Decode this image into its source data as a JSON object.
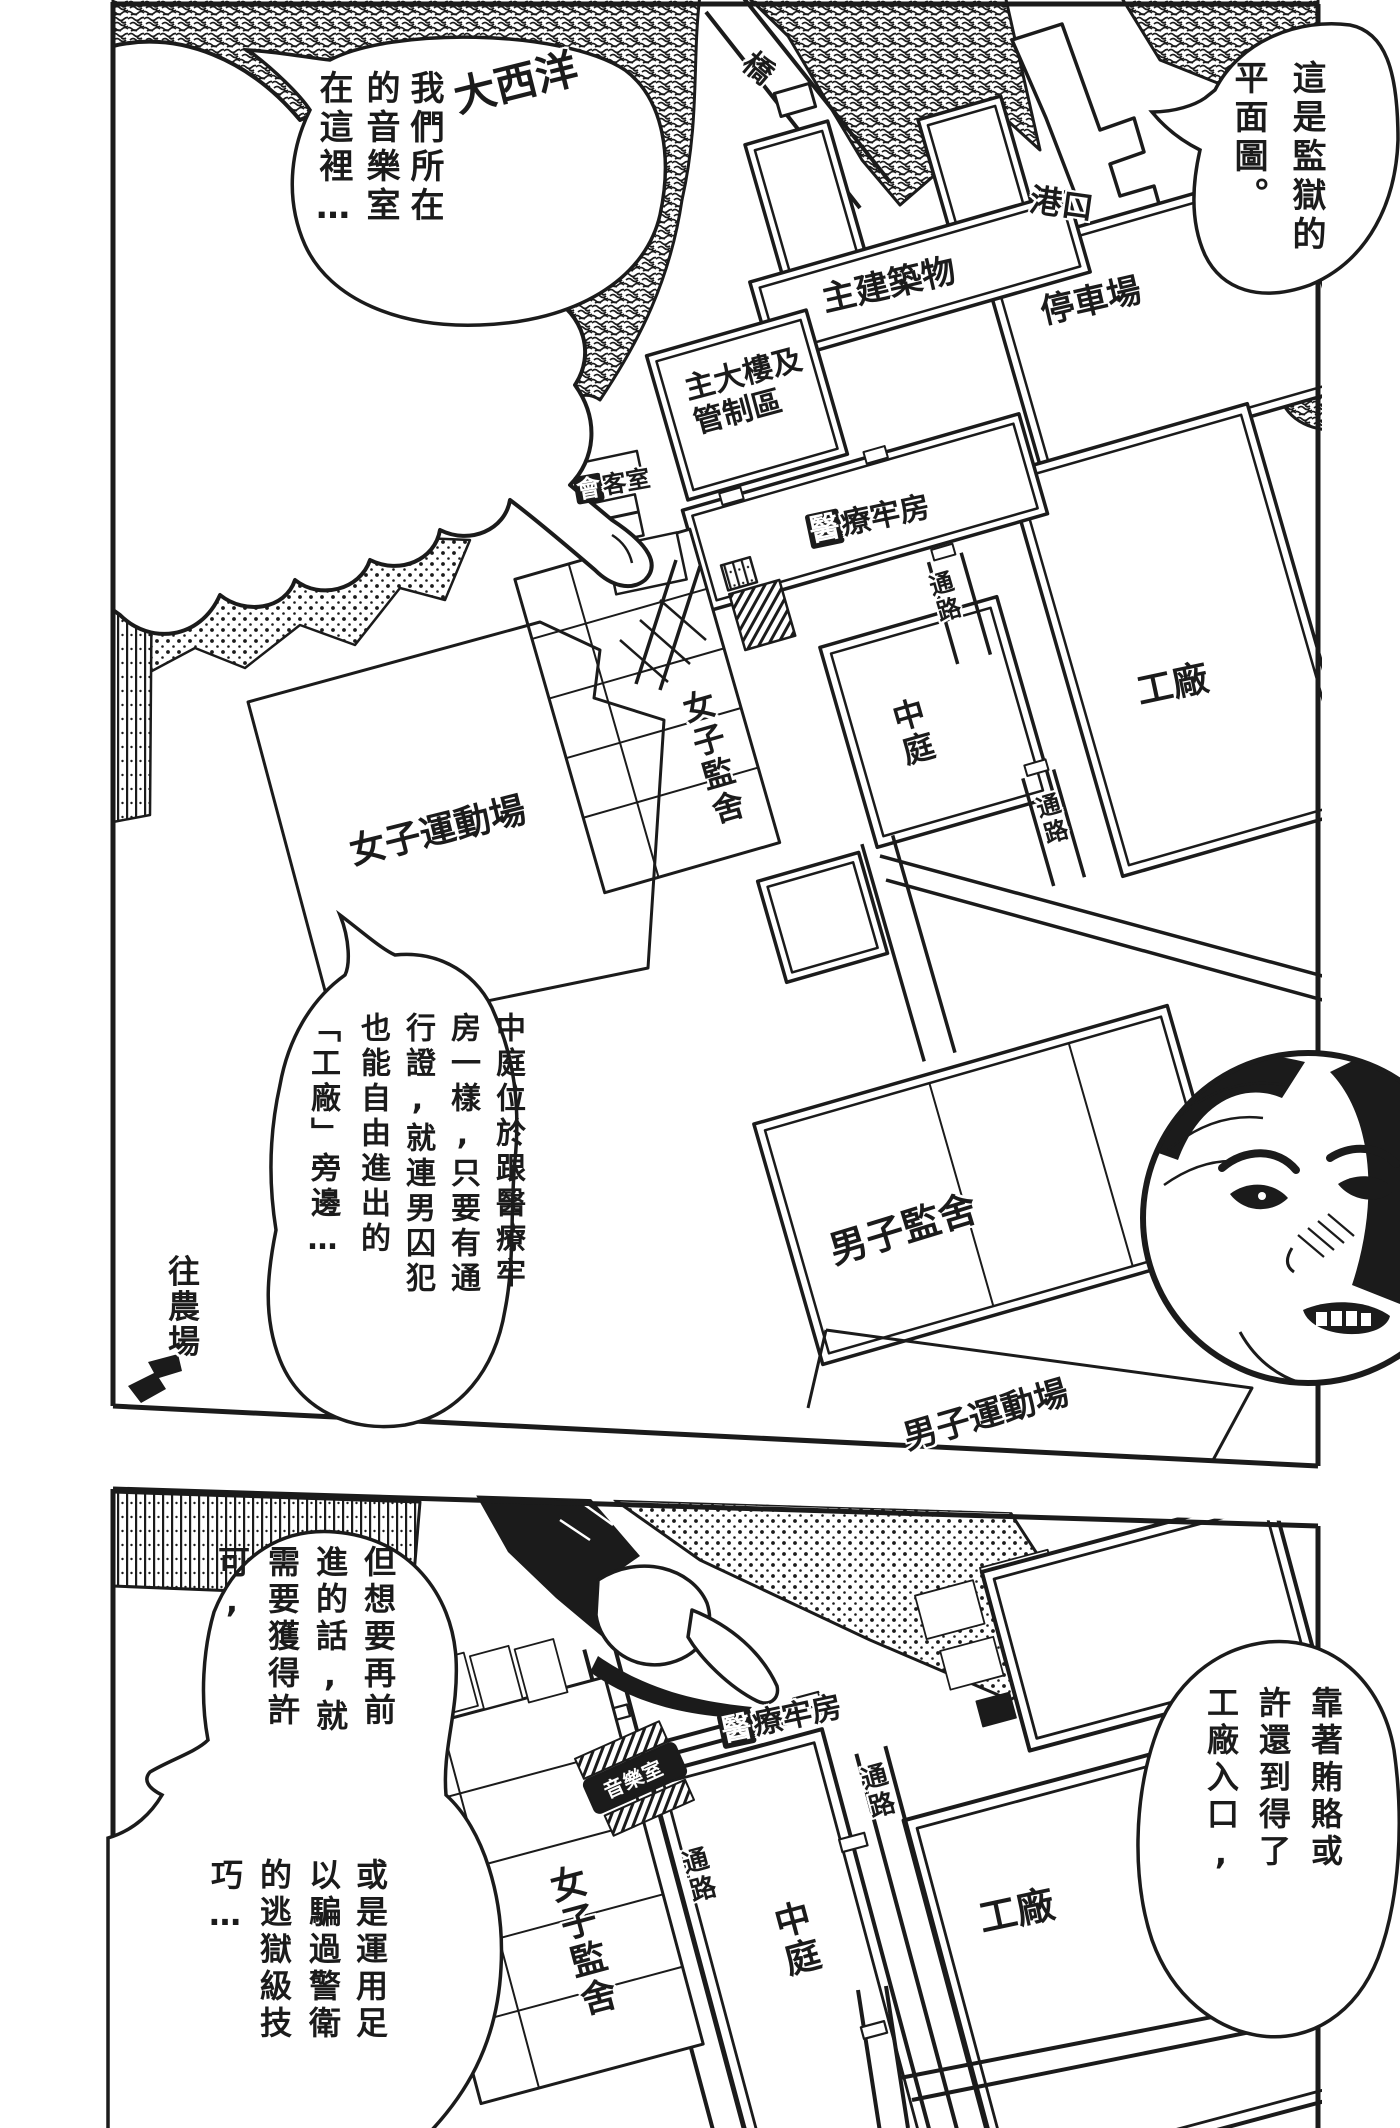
{
  "page": {
    "background": "#ffffff",
    "ink": "#1b1b1b"
  },
  "panel1": {
    "bubbles": {
      "top_left": {
        "columns": [
          "我們所在",
          "的音樂室",
          "在這裡…"
        ]
      },
      "top_right": {
        "columns": [
          "這是監獄的",
          "平面圖。"
        ]
      },
      "middle": {
        "columns": [
          "中庭位於跟醫療牢",
          "房一樣,只要有通",
          "行證,就連男囚犯",
          "也能自由進出的",
          "「工廠」旁邊…"
        ]
      }
    },
    "map_labels": {
      "ocean": "大西洋",
      "bridge": "橋",
      "port": "港口",
      "main_building": "主建築物",
      "parking": "停車場",
      "main_tower": [
        "主大樓及",
        "管制區"
      ],
      "visiting_room": {
        "first": "會",
        "rest": "客室"
      },
      "medical": {
        "first": "醫",
        "rest": "療牢房"
      },
      "passage_mid": "通路",
      "passage_right": "通路",
      "courtyard": "中庭",
      "factory": "工廠",
      "womens_cells": "女子監舍",
      "womens_yard": "女子運動場",
      "mens_cells": "男子監舍",
      "mens_yard": "男子運動場",
      "to_farm": "往農場"
    }
  },
  "panel2": {
    "bubbles": {
      "permission": {
        "columns": [
          "但想要再前",
          "進的話,就",
          "需要獲得許",
          "可,"
        ]
      },
      "technique": {
        "columns": [
          "或是運用足",
          "以騙過警衛",
          "的逃獄級技",
          "巧…"
        ]
      },
      "bribe": {
        "columns": [
          "靠著賄賂或",
          "許還到得了",
          "工廠入口,"
        ]
      }
    },
    "map_labels": {
      "medical": {
        "first": "醫",
        "rest": "療牢房"
      },
      "music_room": "音樂室",
      "passage_upper": "通路",
      "passage_left": "通路",
      "courtyard": "中庭",
      "factory": "工廠",
      "womens_cells": "女子監舍"
    }
  }
}
